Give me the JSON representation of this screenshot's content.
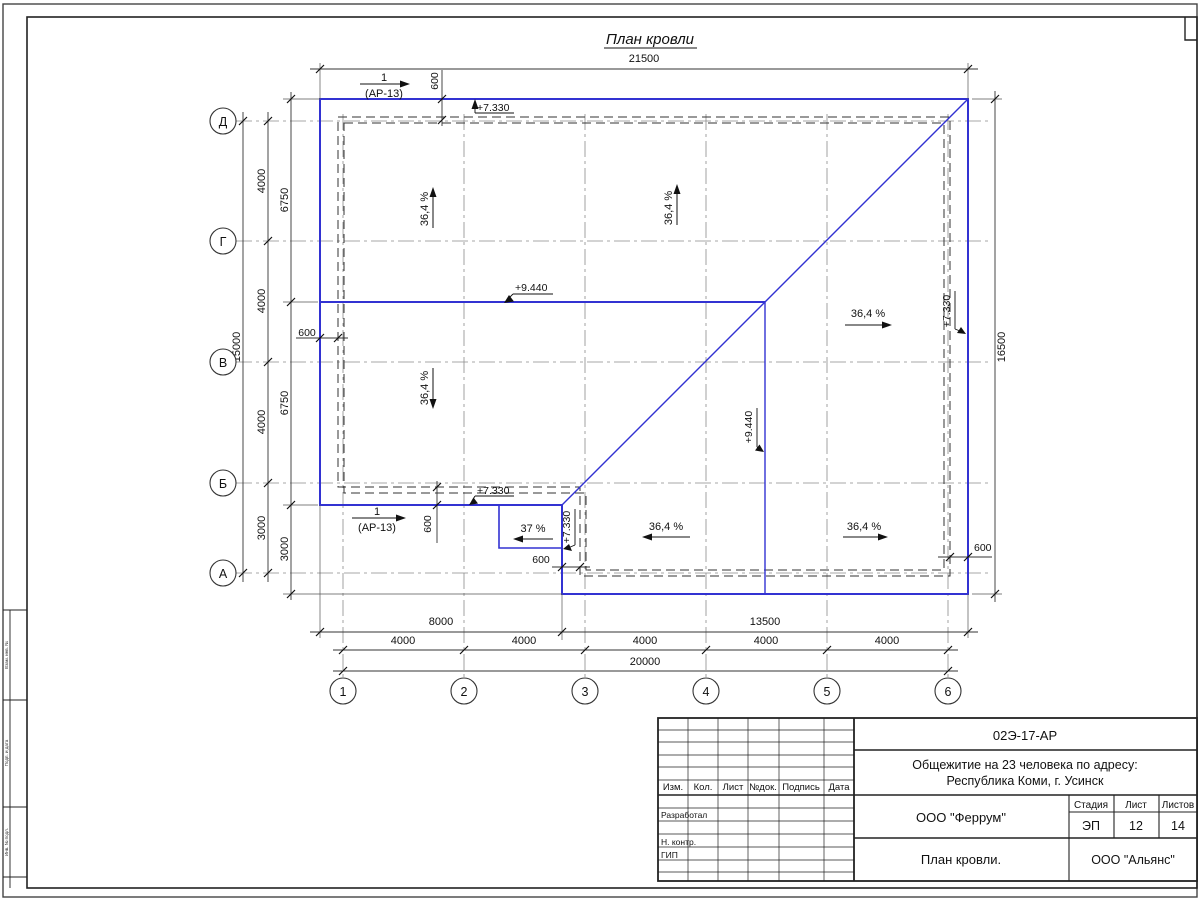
{
  "sheet": {
    "title": "План кровли"
  },
  "axes": {
    "rows": [
      "Д",
      "Г",
      "В",
      "Б",
      "А"
    ],
    "cols": [
      "1",
      "2",
      "3",
      "4",
      "5",
      "6"
    ]
  },
  "dims": {
    "top_total": "21500",
    "left_total": "15000",
    "left_segments": [
      "4000",
      "4000",
      "4000",
      "3000"
    ],
    "left_roof": [
      "6750",
      "6750",
      "3000"
    ],
    "right_total": "16500",
    "bottom_row1": [
      "8000",
      "13500"
    ],
    "bottom_segments": [
      "4000",
      "4000",
      "4000",
      "4000",
      "4000"
    ],
    "bottom_total": "20000",
    "eave": "600"
  },
  "marks": {
    "elev_eaves": "+7.330",
    "elev_ridge": "+9.440",
    "slope_main": "36,4 %",
    "slope_porch": "37 %",
    "section_num": "1",
    "section_ref": "(АР-13)"
  },
  "titleblock": {
    "doc_code": "02Э-17-АР",
    "project_line1": "Общежитие на 23 человека по адресу:",
    "project_line2": "Республика Коми, г. Усинск",
    "designer_org": "ООО \"Феррум\"",
    "drawing_title": "План кровли.",
    "customer_org": "ООО \"Альянс\"",
    "stage_label": "Стадия",
    "sheet_label": "Лист",
    "sheets_label": "Листов",
    "stage": "ЭП",
    "sheet_number": "12",
    "sheets_total": "14",
    "col_headers": [
      "Изм.",
      "Кол.",
      "Лист",
      "№док.",
      "Подпись",
      "Дата"
    ],
    "row_labels": [
      "Разработал",
      "Н. контр.",
      "ГИП"
    ]
  },
  "side_stamp": {
    "labels": [
      "Взам. инв. №",
      "Подп. и дата",
      "Инв. № подл."
    ]
  },
  "colors": {
    "roof_line": "#3232d2",
    "drawing_line": "#333333"
  }
}
